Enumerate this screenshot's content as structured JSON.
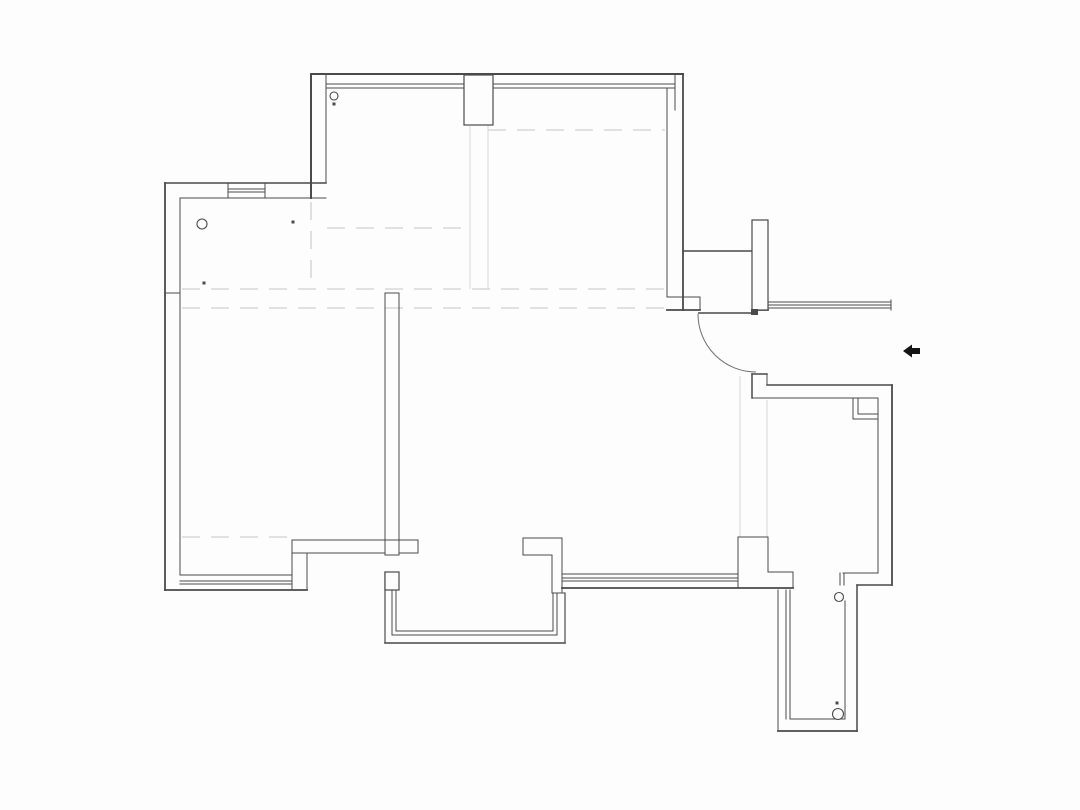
{
  "meta": {
    "canvas_w": 1080,
    "canvas_h": 810,
    "bg": "#fdfdfd",
    "wall_color": "#4a4a4a",
    "arc_color": "#6e6e6e",
    "light_color": "#d8d8d8",
    "arrow_color": "#141414"
  },
  "floorplan": {
    "walls": [
      [
        311,
        74,
        683,
        74,
        2
      ],
      [
        327,
        84,
        675,
        84,
        1
      ],
      [
        327,
        88,
        675,
        88,
        1
      ],
      [
        675,
        74,
        675,
        110,
        1
      ],
      [
        667,
        88,
        675,
        88,
        1
      ],
      [
        311,
        74,
        311,
        198,
        2
      ],
      [
        326,
        74,
        326,
        183,
        1
      ],
      [
        165,
        183,
        326,
        183,
        1.6
      ],
      [
        180,
        198,
        326,
        198,
        1
      ],
      [
        228,
        189,
        265,
        189,
        1
      ],
      [
        228,
        192,
        265,
        192,
        1
      ],
      [
        228,
        183,
        228,
        198,
        1
      ],
      [
        265,
        183,
        265,
        198,
        1
      ],
      [
        165,
        183,
        165,
        590,
        1.8
      ],
      [
        180,
        198,
        180,
        575,
        1
      ],
      [
        165,
        293,
        180,
        293,
        1
      ],
      [
        667,
        88,
        667,
        297,
        1
      ],
      [
        683,
        74,
        683,
        310,
        1.8
      ],
      [
        683,
        251,
        752,
        251,
        1.4
      ],
      [
        667,
        297,
        700,
        297,
        1
      ],
      [
        667,
        310,
        700,
        310,
        1.8
      ],
      [
        700,
        297,
        700,
        310,
        1
      ],
      [
        752,
        310,
        768,
        310,
        1.8
      ],
      [
        768,
        302,
        891,
        302,
        1
      ],
      [
        768,
        305,
        891,
        305,
        1
      ],
      [
        768,
        308,
        891,
        308,
        1
      ],
      [
        891,
        300,
        891,
        310,
        1
      ],
      [
        752,
        374,
        767,
        374,
        1.5
      ],
      [
        752,
        374,
        752,
        398,
        1.5
      ],
      [
        767,
        374,
        767,
        385,
        1
      ],
      [
        767,
        385,
        892,
        385,
        1.5
      ],
      [
        752,
        398,
        878,
        398,
        1
      ],
      [
        892,
        385,
        892,
        585,
        1.8
      ],
      [
        878,
        398,
        878,
        573,
        1
      ],
      [
        853,
        398,
        853,
        419,
        1
      ],
      [
        858,
        398,
        858,
        414,
        1
      ],
      [
        853,
        419,
        878,
        419,
        1
      ],
      [
        858,
        414,
        878,
        414,
        1
      ],
      [
        843,
        573,
        878,
        573,
        1
      ],
      [
        857,
        585,
        892,
        585,
        1.4
      ],
      [
        840,
        573,
        840,
        585,
        1
      ],
      [
        844,
        573,
        844,
        585,
        1
      ],
      [
        857,
        585,
        857,
        731,
        1.5
      ],
      [
        845,
        601,
        845,
        719,
        1
      ],
      [
        778,
        590,
        778,
        731,
        1
      ],
      [
        786,
        590,
        786,
        719,
        1
      ],
      [
        790,
        590,
        790,
        719,
        1
      ],
      [
        790,
        719,
        845,
        719,
        1
      ],
      [
        778,
        731,
        857,
        731,
        1.8
      ],
      [
        738,
        537,
        768,
        537,
        1
      ],
      [
        738,
        537,
        738,
        588,
        1
      ],
      [
        768,
        537,
        768,
        572,
        1
      ],
      [
        768,
        572,
        793,
        572,
        1
      ],
      [
        793,
        572,
        793,
        588,
        1
      ],
      [
        562,
        588,
        793,
        588,
        1.8
      ],
      [
        562,
        574,
        738,
        574,
        1
      ],
      [
        562,
        578,
        738,
        578,
        1
      ],
      [
        562,
        581,
        738,
        581,
        1
      ],
      [
        523,
        538,
        562,
        538,
        1
      ],
      [
        523,
        538,
        523,
        555,
        1
      ],
      [
        523,
        555,
        552,
        555,
        1
      ],
      [
        552,
        555,
        552,
        593,
        1
      ],
      [
        562,
        538,
        562,
        593,
        1
      ],
      [
        552,
        593,
        565,
        593,
        1
      ],
      [
        385,
        572,
        385,
        643,
        1.2
      ],
      [
        392,
        590,
        392,
        635,
        1
      ],
      [
        396,
        590,
        396,
        631,
        1
      ],
      [
        392,
        635,
        557,
        635,
        1
      ],
      [
        396,
        631,
        553,
        631,
        1
      ],
      [
        553,
        593,
        553,
        631,
        1
      ],
      [
        557,
        593,
        557,
        635,
        1
      ],
      [
        385,
        643,
        565,
        643,
        1.6
      ],
      [
        565,
        593,
        565,
        643,
        1.2
      ],
      [
        292,
        540,
        418,
        540,
        1
      ],
      [
        292,
        553,
        385,
        553,
        1
      ],
      [
        399,
        553,
        418,
        553,
        1
      ],
      [
        418,
        540,
        418,
        553,
        1
      ],
      [
        292,
        540,
        292,
        590,
        1
      ],
      [
        307,
        553,
        307,
        590,
        1
      ],
      [
        385,
        293,
        385,
        555,
        1
      ],
      [
        399,
        293,
        399,
        555,
        1
      ],
      [
        385,
        293,
        399,
        293,
        1
      ],
      [
        385,
        555,
        399,
        555,
        1
      ],
      [
        180,
        575,
        292,
        575,
        1
      ],
      [
        180,
        581,
        292,
        581,
        1
      ],
      [
        180,
        584,
        292,
        584,
        1
      ],
      [
        165,
        590,
        307,
        590,
        1.8
      ]
    ],
    "light_lines": [
      [
        740,
        376,
        740,
        537
      ],
      [
        767,
        400,
        767,
        537
      ],
      [
        470,
        126,
        470,
        289
      ],
      [
        488,
        91,
        488,
        289
      ]
    ],
    "dashed_lines": [
      [
        182,
        289,
        667,
        289
      ],
      [
        182,
        308,
        667,
        308
      ],
      [
        488,
        130,
        665,
        130
      ],
      [
        327,
        228,
        470,
        228
      ],
      [
        311,
        202,
        311,
        289
      ],
      [
        182,
        537,
        292,
        537
      ]
    ],
    "white_rects": [
      [
        464,
        75,
        29,
        50
      ],
      [
        752,
        220,
        16,
        90
      ],
      [
        385,
        572,
        14,
        18
      ]
    ],
    "circles": [
      [
        334,
        96,
        4
      ],
      [
        202,
        224,
        5
      ],
      [
        839,
        597,
        4.5
      ],
      [
        838,
        714,
        5.5
      ]
    ],
    "dots": [
      [
        334,
        104
      ],
      [
        293,
        222
      ],
      [
        204,
        283
      ],
      [
        837,
        703
      ]
    ],
    "door": {
      "leaf": [
        698,
        313,
        758,
        313
      ],
      "hinge": [
        751,
        309,
        7,
        6
      ],
      "arc": "M 698 314 A 58 58 0 0 0 756 372"
    },
    "arrow_points": "903,351 912,344.5 912,348 920,348 920,354 912,354 912,357.5"
  }
}
